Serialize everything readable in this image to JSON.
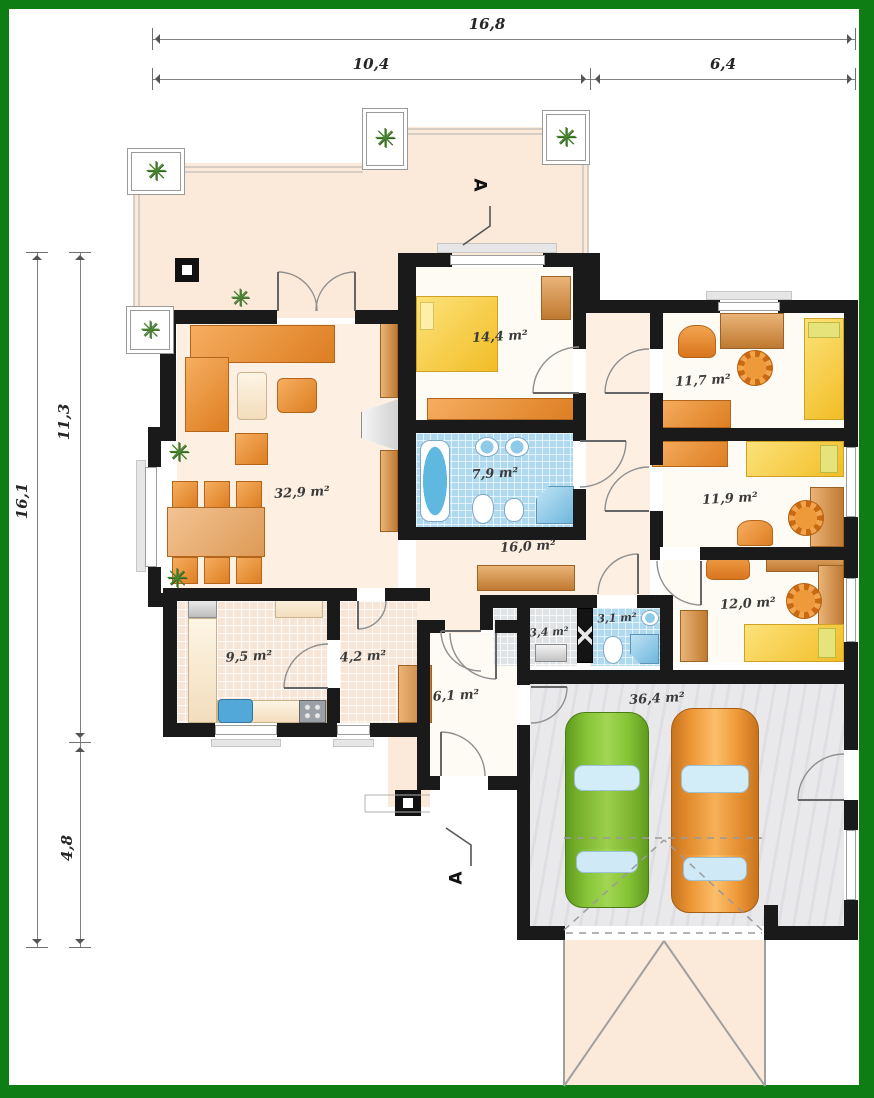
{
  "plan": {
    "type": "architectural-floor-plan",
    "dims_top": [
      {
        "label": "16,8"
      },
      {
        "label": "10,4"
      },
      {
        "label": "6,4"
      }
    ],
    "dims_left": [
      {
        "label": "16,1"
      },
      {
        "label": "11,3"
      },
      {
        "label": "4,8"
      }
    ],
    "section_top": "A",
    "section_bottom": "A",
    "rooms": [
      {
        "name": "living-room",
        "area": "32,9 m²"
      },
      {
        "name": "bedroom",
        "area": "14,4 m²"
      },
      {
        "name": "bathroom",
        "area": "7,9 m²"
      },
      {
        "name": "hall",
        "area": "16,0 m²"
      },
      {
        "name": "room-a",
        "area": "11,7 m²"
      },
      {
        "name": "room-b",
        "area": "11,9 m²"
      },
      {
        "name": "room-c",
        "area": "12,0 m²"
      },
      {
        "name": "kitchen",
        "area": "9,5 m²"
      },
      {
        "name": "corridor",
        "area": "4,2 m²"
      },
      {
        "name": "utility",
        "area": "3,4 m²"
      },
      {
        "name": "wc",
        "area": "3,1 m²"
      },
      {
        "name": "vestibule",
        "area": "6,1 m²"
      },
      {
        "name": "garage",
        "area": "36,4 m²"
      }
    ],
    "icons": {
      "plant_glyph": "✳"
    },
    "colors": {
      "border_green": "#0e7d14",
      "wall_black": "#1a1a1a",
      "floor_cream": "#fdf0e2",
      "furniture_orange": "#e8892f",
      "bed_yellow": "#f4c83a",
      "bath_blue": "#aed9ee",
      "car_green": "#86c437",
      "car_orange": "#f09a3a"
    }
  }
}
